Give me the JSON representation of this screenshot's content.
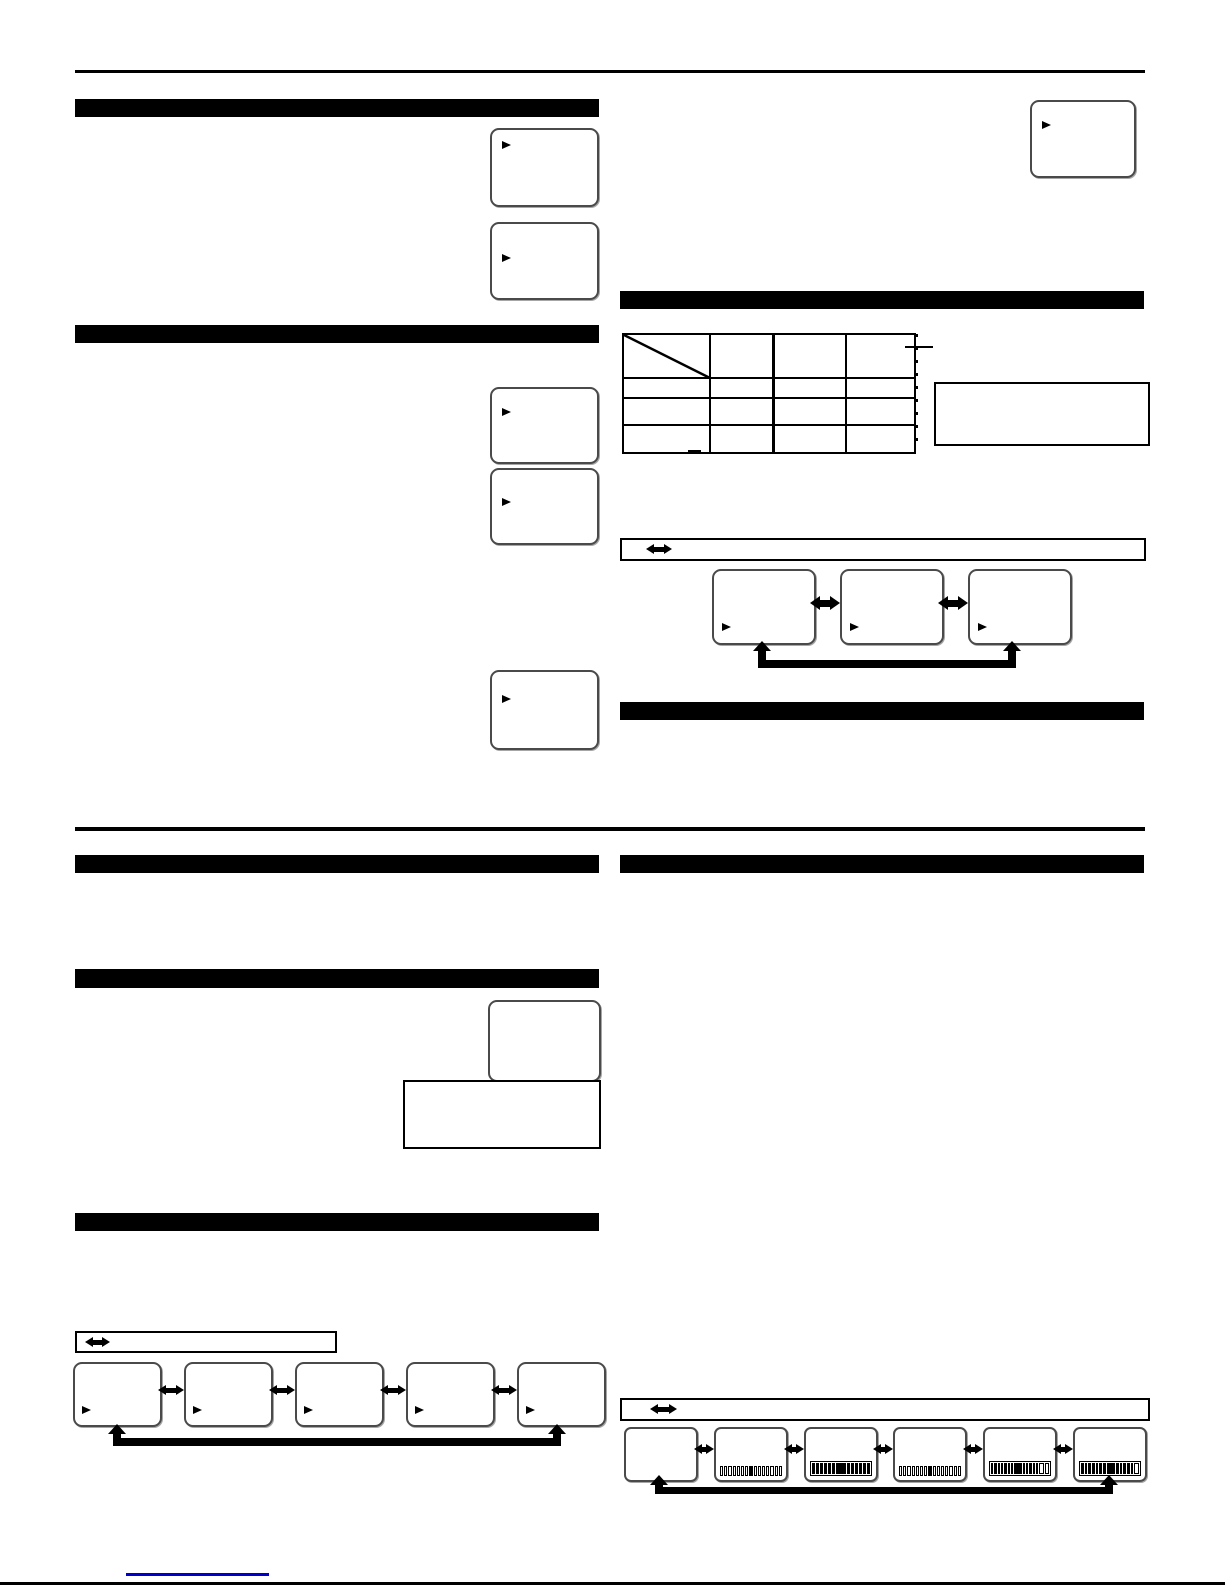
{
  "document": {
    "kind": "scanned instruction-manual page",
    "visible_text": "",
    "all_cells_blank": true
  },
  "colors": {
    "paper": "#ffffff",
    "ink": "#000000",
    "screen_border": "#4a4a4a",
    "link_underline": "#0000cc"
  },
  "sections": {
    "left_1": {
      "heading": ""
    },
    "left_2": {
      "heading": ""
    },
    "left_3": {
      "heading": ""
    },
    "left_4": {
      "heading": ""
    },
    "left_5": {
      "heading": ""
    },
    "right_1": {
      "heading": ""
    },
    "right_2": {
      "heading": ""
    },
    "right_3": {
      "heading": ""
    }
  },
  "table": {
    "columns": 4,
    "rows": 4,
    "header_diagonal_split": true,
    "headers": [
      "",
      "",
      "",
      ""
    ],
    "cells": [
      [
        "",
        "",
        "",
        ""
      ],
      [
        "",
        "",
        "",
        ""
      ],
      [
        "",
        "",
        "",
        ""
      ]
    ],
    "footnote_mark": "",
    "note_box_text": ""
  },
  "screens": {
    "left_top_1": {
      "label": "",
      "cursor": true
    },
    "left_top_2": {
      "label": "",
      "cursor": true
    },
    "left_mid_1": {
      "label": "",
      "cursor": true
    },
    "left_mid_2": {
      "label": "",
      "cursor": true
    },
    "left_mid_3": {
      "label": "",
      "cursor": true
    },
    "top_right": {
      "label": "",
      "cursor": true
    },
    "lower_left_screen": {
      "label": "",
      "cursor": false
    },
    "lower_left_note": {
      "label": ""
    }
  },
  "flows": {
    "three_screen_cycle": {
      "legend_text": "",
      "bidirectional": true,
      "loop_back": true,
      "boxes": [
        {
          "cursor": true,
          "label": ""
        },
        {
          "cursor": true,
          "label": ""
        },
        {
          "cursor": true,
          "label": ""
        }
      ]
    },
    "five_screen_cycle": {
      "legend_text": "",
      "bidirectional": true,
      "loop_back": true,
      "boxes": [
        {
          "cursor": true,
          "label": ""
        },
        {
          "cursor": true,
          "label": ""
        },
        {
          "cursor": true,
          "label": ""
        },
        {
          "cursor": true,
          "label": ""
        },
        {
          "cursor": true,
          "label": ""
        }
      ]
    },
    "six_screen_cycle": {
      "legend_text": "",
      "bidirectional": true,
      "loop_back": true,
      "boxes": [
        {
          "style": "none",
          "pattern": ""
        },
        {
          "style": "cells",
          "pattern": "wwwwwwwbwwwwwww"
        },
        {
          "style": "bar",
          "pattern": "bbbbbbBbbbbbb"
        },
        {
          "style": "cells",
          "pattern": "wwwwwwwbwwwwwww"
        },
        {
          "style": "bar",
          "pattern": "bbbbbbbBbbbbbww"
        },
        {
          "style": "bar",
          "pattern": "bbbbbbbBbbbbbw"
        }
      ]
    }
  },
  "link": {
    "text": ""
  }
}
